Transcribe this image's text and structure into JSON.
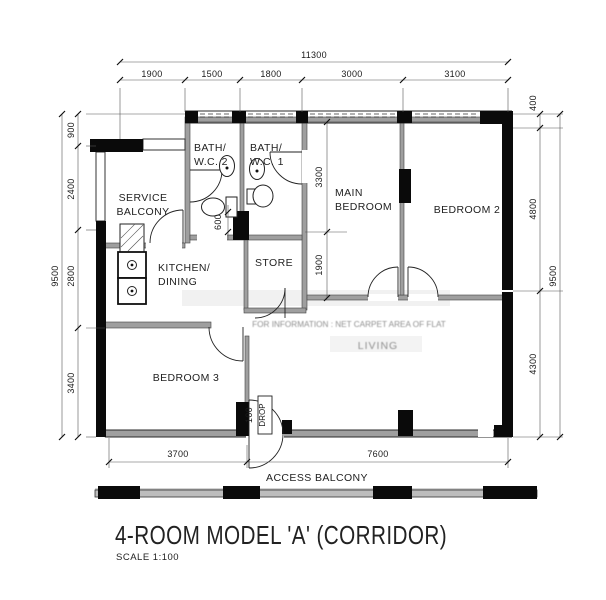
{
  "title": {
    "name": "4-ROOM MODEL 'A' (CORRIDOR)",
    "scale": "SCALE 1:100"
  },
  "rooms": {
    "service_balcony": [
      "SERVICE",
      "BALCONY"
    ],
    "bath_wc_2": [
      "BATH/",
      "W.C. 2"
    ],
    "bath_wc_1": [
      "BATH/",
      "W.C. 1"
    ],
    "main_bedroom": [
      "MAIN",
      "BEDROOM"
    ],
    "bedroom_2": "BEDROOM 2",
    "kitchen_dining": [
      "KITCHEN/",
      "DINING"
    ],
    "store": "STORE",
    "living": "LIVING",
    "bedroom_3": "BEDROOM 3",
    "access_balcony": "ACCESS BALCONY"
  },
  "watermark": "FOR INFORMATION : NET CARPET AREA OF FLAT",
  "dimensions": {
    "top": {
      "overall": "11300",
      "segments": [
        "1900",
        "1500",
        "1800",
        "3000",
        "3100"
      ]
    },
    "left": {
      "overall": "9500",
      "segments": [
        "900",
        "2400",
        "2800",
        "3400"
      ]
    },
    "right": {
      "overall": "9500",
      "segments": [
        "400",
        "4800",
        "4300"
      ]
    },
    "bottom": {
      "segments": [
        "3700",
        "7600"
      ]
    },
    "interior": {
      "main_bedroom_depth": "3300",
      "main_bedroom_lower": "1900",
      "bath_recess": "600",
      "entrance_step": "100",
      "entrance_step_label": "DROP"
    }
  },
  "colors": {
    "wall_black": "#0a0a0a",
    "wall_light": "#9f9f9f",
    "paper": "#ffffff"
  }
}
